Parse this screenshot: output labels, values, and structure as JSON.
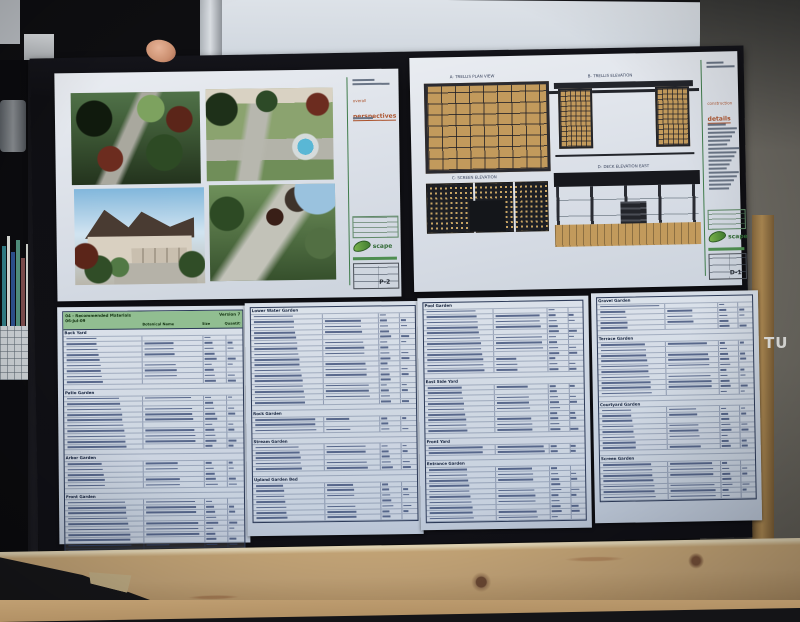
{
  "scene": {
    "description": "photo of a black presentation board with landscape-design sheets, held above a wooden table",
    "sign_text": "TU"
  },
  "perspectives_sheet": {
    "heading_small": "overall",
    "heading": "perspectives",
    "logo_text": "scape",
    "sheet_number": "P-2",
    "renders": [
      {
        "name": "garden-path-render"
      },
      {
        "name": "backyard-spa-render"
      },
      {
        "name": "house-front-render"
      },
      {
        "name": "side-garden-render"
      }
    ]
  },
  "details_sheet": {
    "heading_small": "construction",
    "heading": "details",
    "logo_text": "scape",
    "sheet_number": "D-1",
    "drawings": [
      {
        "title": "A- TRELLIS PLAN VIEW"
      },
      {
        "title": "B- TRELLIS ELEVATION"
      },
      {
        "title": "C- SCREEN ELEVATION"
      },
      {
        "title": "D- DECK ELEVATION EAST"
      }
    ]
  },
  "schedules": [
    {
      "header": {
        "title": "04 - Recommended Materials",
        "version": "Version 7",
        "date": "06-Jul-09",
        "columns": [
          "Botanical Name",
          "Size",
          "Quantity"
        ]
      },
      "sections": [
        {
          "label": "Back Yard",
          "rows": 9
        },
        {
          "label": "Patio Garden",
          "rows": 10
        },
        {
          "label": "Arbor Garden",
          "rows": 5
        },
        {
          "label": "Front Garden",
          "rows": 10
        }
      ]
    },
    {
      "header": null,
      "sections": [
        {
          "label": "Lower Water Garden",
          "rows": 17
        },
        {
          "label": "Rock Garden",
          "rows": 3
        },
        {
          "label": "Stream Garden",
          "rows": 5
        },
        {
          "label": "Upland Garden Bed",
          "rows": 7
        }
      ]
    },
    {
      "header": null,
      "sections": [
        {
          "label": "Pool Garden",
          "rows": 12
        },
        {
          "label": "East Side Yard",
          "rows": 9
        },
        {
          "label": "Front Yard",
          "rows": 2
        },
        {
          "label": "Entrance Garden",
          "rows": 10
        }
      ]
    },
    {
      "header": null,
      "sections": [
        {
          "label": "Gravel Garden",
          "rows": 5
        },
        {
          "label": "Terrace Garden",
          "rows": 10
        },
        {
          "label": "Courtyard Garden",
          "rows": 8
        },
        {
          "label": "Screen Garden",
          "rows": 7
        }
      ]
    }
  ]
}
